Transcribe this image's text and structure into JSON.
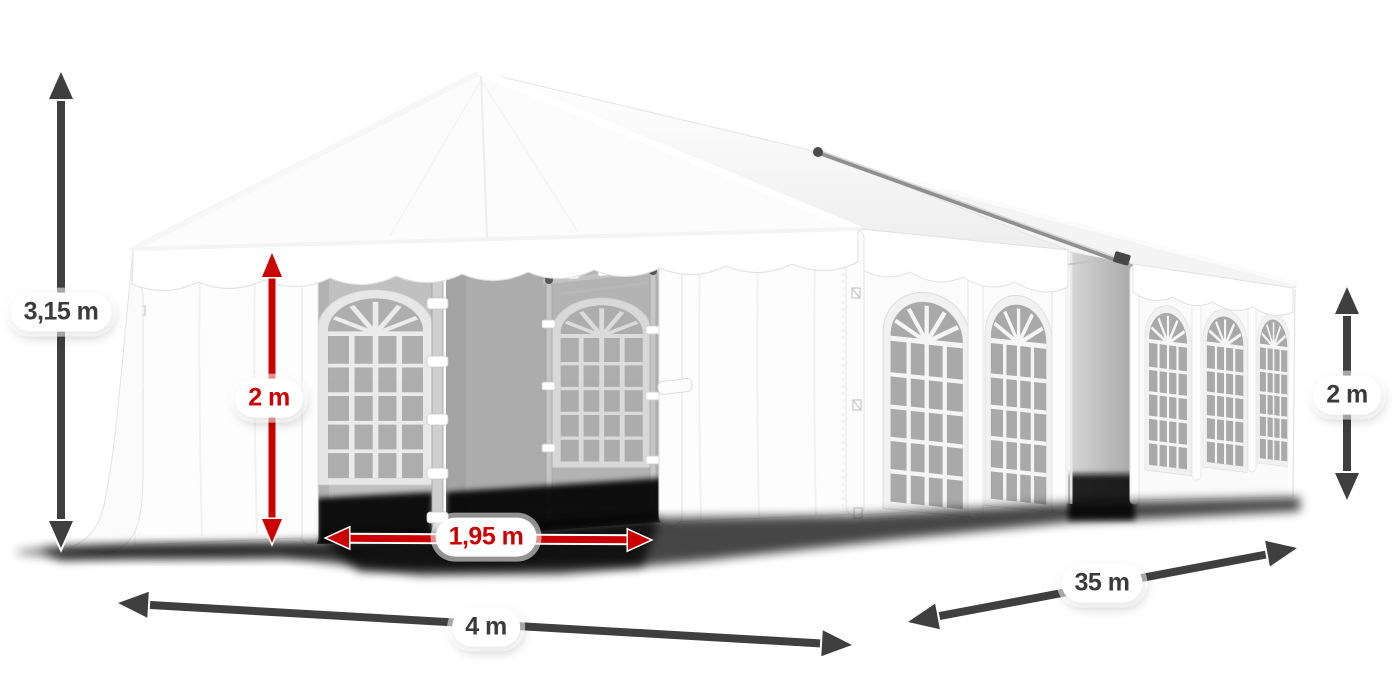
{
  "diagram": {
    "illustration": "white-party-tent-with-dimensions",
    "labels": {
      "total_height": "3,15 m",
      "entrance_height": "2 m",
      "entrance_width": "1,95 m",
      "front_width": "4 m",
      "length": "35 m",
      "side_wall_height": "2 m"
    },
    "colors": {
      "dimension_dark": "#3f3f3f",
      "dimension_red": "#cc0000",
      "label_background": "#ffffff",
      "label_text_dark": "#3b3b3b",
      "tent_white": "#ffffff",
      "interior_grey": "#b5b5b5",
      "window_glass_grey": "#a9a9a9"
    }
  }
}
